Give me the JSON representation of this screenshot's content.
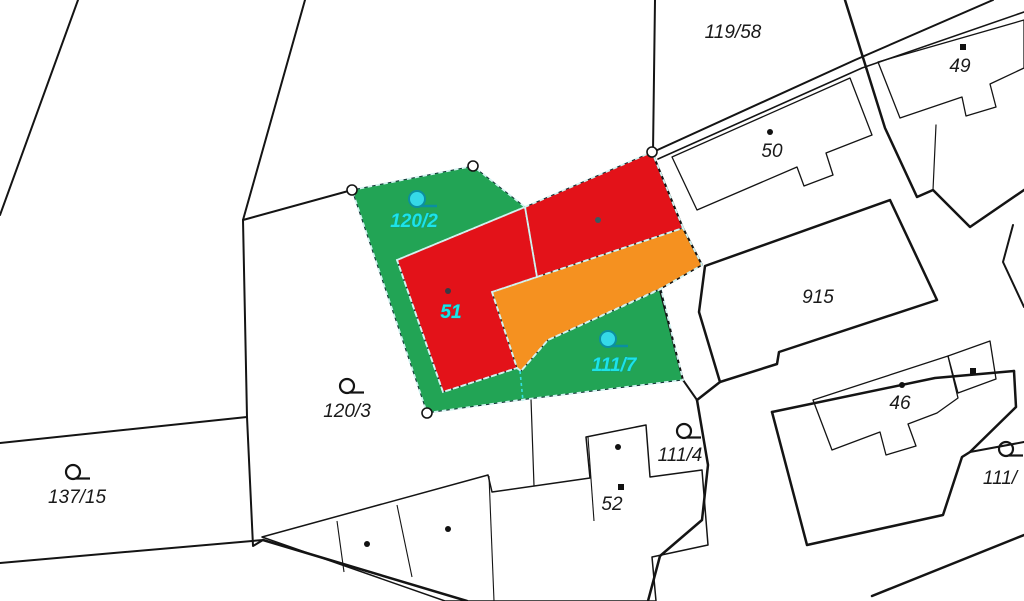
{
  "map": {
    "kind": "cadastral-parcel-map",
    "canvas": {
      "width": 1024,
      "height": 601,
      "background": "#ffffff"
    },
    "colors": {
      "line": "#141414",
      "green_parcel": "#22a455",
      "red_building": "#e31219",
      "orange_building": "#f59120",
      "dash_overlay": "#d2f3f0",
      "inner_dash": "#35dfe2",
      "division_gray": "#5a6a6e",
      "cyan_symbol_fill": "#35d9e8",
      "cyan_symbol_stroke": "#0b8fa0",
      "label_black": "#1a1a1a",
      "label_cyan": "#1de4e6"
    },
    "colored_parcels": [
      {
        "name": "parcel-green-120-2-and-111-7",
        "fill": "green_parcel",
        "points": [
          [
            352,
            190
          ],
          [
            473,
            166
          ],
          [
            525,
            207
          ],
          [
            397,
            260
          ],
          [
            443,
            392
          ],
          [
            517,
            368
          ],
          [
            521,
            371
          ],
          [
            548,
            340
          ],
          [
            661,
            289
          ],
          [
            683,
            380
          ],
          [
            520,
            400
          ],
          [
            427,
            413
          ]
        ]
      },
      {
        "name": "building-51-red-west",
        "fill": "red_building",
        "points": [
          [
            397,
            260
          ],
          [
            525,
            207
          ],
          [
            537,
            277
          ],
          [
            492,
            292
          ],
          [
            517,
            368
          ],
          [
            443,
            392
          ]
        ]
      },
      {
        "name": "building-51-red-east",
        "fill": "red_building",
        "points": [
          [
            525,
            207
          ],
          [
            652,
            152
          ],
          [
            683,
            228
          ],
          [
            537,
            277
          ]
        ]
      },
      {
        "name": "building-51-orange-annex",
        "fill": "orange_building",
        "points": [
          [
            492,
            292
          ],
          [
            683,
            228
          ],
          [
            702,
            265
          ],
          [
            662,
            288
          ],
          [
            548,
            340
          ],
          [
            521,
            371
          ],
          [
            517,
            368
          ]
        ]
      }
    ],
    "boundary_lines": [
      {
        "name": "parcel-line",
        "w": 2,
        "pts": [
          [
            78,
            0
          ],
          [
            0,
            215
          ]
        ]
      },
      {
        "name": "parcel-line",
        "w": 2,
        "pts": [
          [
            305,
            0
          ],
          [
            243,
            220
          ]
        ]
      },
      {
        "name": "parcel-line",
        "w": 2,
        "pts": [
          [
            243,
            220
          ],
          [
            352,
            190
          ]
        ]
      },
      {
        "name": "parcel-line",
        "w": 2,
        "pts": [
          [
            243,
            220
          ],
          [
            247,
            417
          ],
          [
            253,
            546
          ],
          [
            263,
            540
          ]
        ]
      },
      {
        "name": "parcel-line",
        "w": 2,
        "pts": [
          [
            0,
            443
          ],
          [
            247,
            417
          ]
        ]
      },
      {
        "name": "parcel-line",
        "w": 2,
        "pts": [
          [
            0,
            563
          ],
          [
            263,
            540
          ]
        ]
      },
      {
        "name": "parcel-line",
        "w": 2.5,
        "pts": [
          [
            263,
            540
          ],
          [
            467,
            601
          ]
        ]
      },
      {
        "name": "parcel-line",
        "w": 2,
        "pts": [
          [
            655,
            0
          ],
          [
            653,
            152
          ]
        ]
      },
      {
        "name": "road-edge-line",
        "w": 2,
        "pts": [
          [
            653,
            152
          ],
          [
            855,
            60
          ],
          [
            993,
            0
          ]
        ]
      },
      {
        "name": "road-edge-line",
        "w": 1.6,
        "pts": [
          [
            658,
            159
          ],
          [
            862,
            68
          ],
          [
            1024,
            12
          ]
        ]
      },
      {
        "name": "parcel-line",
        "w": 2.5,
        "pts": [
          [
            845,
            0
          ],
          [
            885,
            128
          ],
          [
            917,
            197
          ],
          [
            933,
            190
          ],
          [
            970,
            227
          ],
          [
            1024,
            190
          ]
        ]
      },
      {
        "name": "parcel-line",
        "w": 2,
        "pts": [
          [
            1013,
            225
          ],
          [
            1003,
            262
          ],
          [
            1024,
            307
          ]
        ]
      },
      {
        "name": "parcel-line",
        "w": 1.2,
        "pts": [
          [
            936,
            125
          ],
          [
            933,
            190
          ]
        ]
      },
      {
        "name": "parcel-line",
        "w": 2,
        "pts": [
          [
            652,
            152
          ],
          [
            683,
            228
          ],
          [
            702,
            265
          ]
        ]
      },
      {
        "name": "parcel-line",
        "w": 1.5,
        "pts": [
          [
            702,
            265
          ],
          [
            662,
            288
          ]
        ]
      },
      {
        "name": "parcel-line",
        "w": 2,
        "pts": [
          [
            660,
            290
          ],
          [
            683,
            380
          ],
          [
            697,
            400
          ]
        ]
      },
      {
        "name": "parcel-line",
        "w": 2.5,
        "pts": [
          [
            720,
            382
          ],
          [
            697,
            400
          ]
        ]
      },
      {
        "name": "parcel-line",
        "w": 2.5,
        "pts": [
          [
            697,
            400
          ],
          [
            708,
            465
          ],
          [
            702,
            520
          ],
          [
            660,
            556
          ],
          [
            648,
            601
          ]
        ]
      },
      {
        "name": "parcel-line",
        "w": 2.5,
        "pts": [
          [
            772,
            412
          ],
          [
            935,
            378
          ],
          [
            1014,
            371
          ]
        ]
      },
      {
        "name": "parcel-line",
        "w": 2.5,
        "pts": [
          [
            1014,
            371
          ],
          [
            1016,
            407
          ],
          [
            970,
            452
          ],
          [
            962,
            457
          ],
          [
            943,
            515
          ],
          [
            807,
            545
          ],
          [
            772,
            412
          ]
        ]
      },
      {
        "name": "parcel-line",
        "w": 2,
        "pts": [
          [
            970,
            452
          ],
          [
            1024,
            442
          ]
        ]
      },
      {
        "name": "road-edge-line",
        "w": 2.5,
        "pts": [
          [
            872,
            596
          ],
          [
            1024,
            535
          ]
        ]
      },
      {
        "name": "parcel-line",
        "w": 1.2,
        "pts": [
          [
            531,
            399
          ],
          [
            534,
            486
          ]
        ]
      }
    ],
    "thick_parcels": [
      {
        "name": "parcel-915-outline",
        "w": 2.5,
        "points": [
          [
            705,
            266
          ],
          [
            890,
            200
          ],
          [
            937,
            300
          ],
          [
            779,
            352
          ],
          [
            777,
            364
          ],
          [
            720,
            382
          ],
          [
            699,
            312
          ]
        ]
      }
    ],
    "buildings": [
      {
        "name": "building-50-footprint",
        "w": 1.3,
        "closed": true,
        "points": [
          [
            672,
            157
          ],
          [
            850,
            78
          ],
          [
            872,
            135
          ],
          [
            826,
            153
          ],
          [
            833,
            175
          ],
          [
            804,
            186
          ],
          [
            797,
            167
          ],
          [
            697,
            210
          ]
        ]
      },
      {
        "name": "building-49-footprint",
        "w": 1.3,
        "closed": true,
        "points": [
          [
            878,
            62
          ],
          [
            1024,
            20
          ],
          [
            1024,
            68
          ],
          [
            990,
            84
          ],
          [
            996,
            107
          ],
          [
            966,
            116
          ],
          [
            962,
            97
          ],
          [
            900,
            118
          ]
        ]
      },
      {
        "name": "building-46-footprint",
        "w": 1.3,
        "closed": true,
        "points": [
          [
            813,
            400
          ],
          [
            948,
            356
          ],
          [
            958,
            398
          ],
          [
            937,
            413
          ],
          [
            908,
            424
          ],
          [
            916,
            446
          ],
          [
            886,
            455
          ],
          [
            880,
            432
          ],
          [
            832,
            450
          ]
        ]
      },
      {
        "name": "building-46-annex-footprint",
        "w": 1.3,
        "closed": true,
        "points": [
          [
            948,
            356
          ],
          [
            990,
            341
          ],
          [
            996,
            379
          ],
          [
            958,
            393
          ]
        ]
      },
      {
        "name": "building-52-row-footprint",
        "w": 1.5,
        "closed": true,
        "points": [
          [
            262,
            537
          ],
          [
            488,
            475
          ],
          [
            492,
            492
          ],
          [
            590,
            478
          ],
          [
            586,
            437
          ],
          [
            646,
            425
          ],
          [
            650,
            477
          ],
          [
            702,
            470
          ],
          [
            708,
            545
          ],
          [
            652,
            557
          ],
          [
            656,
            601
          ],
          [
            445,
            601
          ]
        ]
      }
    ],
    "building_divisions": [
      {
        "w": 1.1,
        "pts": [
          [
            337,
            521
          ],
          [
            344,
            572
          ]
        ]
      },
      {
        "w": 1.1,
        "pts": [
          [
            397,
            505
          ],
          [
            412,
            577
          ]
        ]
      },
      {
        "w": 1.1,
        "pts": [
          [
            489,
            476
          ],
          [
            494,
            601
          ]
        ]
      },
      {
        "w": 1.1,
        "pts": [
          [
            588,
            437
          ],
          [
            594,
            521
          ]
        ]
      }
    ],
    "division_line_gray": {
      "pts": [
        [
          525,
          207
        ],
        [
          537,
          277
        ]
      ],
      "w": 1.6
    },
    "inner_dashed_line": {
      "pts": [
        [
          520,
          371
        ],
        [
          523,
          401
        ]
      ],
      "w": 1.6
    },
    "vertex_markers": [
      [
        352,
        190
      ],
      [
        473,
        166
      ],
      [
        652,
        152
      ],
      [
        427,
        413
      ]
    ],
    "symbols_black": [
      {
        "name": "land-use-symbol",
        "x": 347,
        "y": 386
      },
      {
        "name": "land-use-symbol",
        "x": 73,
        "y": 472
      },
      {
        "name": "land-use-symbol",
        "x": 684,
        "y": 431
      },
      {
        "name": "land-use-symbol",
        "x": 1006,
        "y": 449
      }
    ],
    "symbols_cyan": [
      {
        "name": "land-use-symbol-selected",
        "x": 417,
        "y": 199
      },
      {
        "name": "land-use-symbol-selected",
        "x": 608,
        "y": 339
      }
    ],
    "building_points": [
      {
        "x": 770,
        "y": 132,
        "shape": "circle",
        "color": "#111111"
      },
      {
        "x": 963,
        "y": 47,
        "shape": "square",
        "color": "#111111"
      },
      {
        "x": 902,
        "y": 385,
        "shape": "circle",
        "color": "#111111"
      },
      {
        "x": 973,
        "y": 371,
        "shape": "square",
        "color": "#111111"
      },
      {
        "x": 367,
        "y": 544,
        "shape": "circle",
        "color": "#111111"
      },
      {
        "x": 448,
        "y": 529,
        "shape": "circle",
        "color": "#111111"
      },
      {
        "x": 618,
        "y": 447,
        "shape": "circle",
        "color": "#111111"
      },
      {
        "x": 621,
        "y": 487,
        "shape": "square",
        "color": "#111111"
      },
      {
        "x": 448,
        "y": 291,
        "shape": "circle",
        "color": "#3a3a44"
      },
      {
        "x": 598,
        "y": 220,
        "shape": "circle",
        "color": "#3a5a60"
      }
    ],
    "labels": [
      {
        "name": "parcel-label-119-58",
        "text": "119/58",
        "x": 733,
        "y": 38,
        "style": "black"
      },
      {
        "name": "parcel-label-49",
        "text": "49",
        "x": 960,
        "y": 72,
        "style": "black"
      },
      {
        "name": "parcel-label-50",
        "text": "50",
        "x": 772,
        "y": 157,
        "style": "black"
      },
      {
        "name": "parcel-label-915",
        "text": "915",
        "x": 818,
        "y": 303,
        "style": "black"
      },
      {
        "name": "parcel-label-46",
        "text": "46",
        "x": 900,
        "y": 409,
        "style": "black"
      },
      {
        "name": "parcel-label-120-3",
        "text": "120/3",
        "x": 347,
        "y": 417,
        "style": "black"
      },
      {
        "name": "parcel-label-137-15",
        "text": "137/15",
        "x": 77,
        "y": 503,
        "style": "black"
      },
      {
        "name": "parcel-label-111-4",
        "text": "111/4",
        "x": 680,
        "y": 461,
        "style": "black"
      },
      {
        "name": "parcel-label-52",
        "text": "52",
        "x": 612,
        "y": 510,
        "style": "black"
      },
      {
        "name": "parcel-label-111-cut",
        "text": "111/",
        "x": 1000,
        "y": 484,
        "style": "black"
      },
      {
        "name": "parcel-label-120-2",
        "text": "120/2",
        "x": 414,
        "y": 227,
        "style": "cyan"
      },
      {
        "name": "parcel-label-111-7",
        "text": "111/7",
        "x": 614,
        "y": 371,
        "style": "cyan"
      },
      {
        "name": "parcel-label-51",
        "text": "51",
        "x": 451,
        "y": 318,
        "style": "cyan"
      }
    ]
  }
}
